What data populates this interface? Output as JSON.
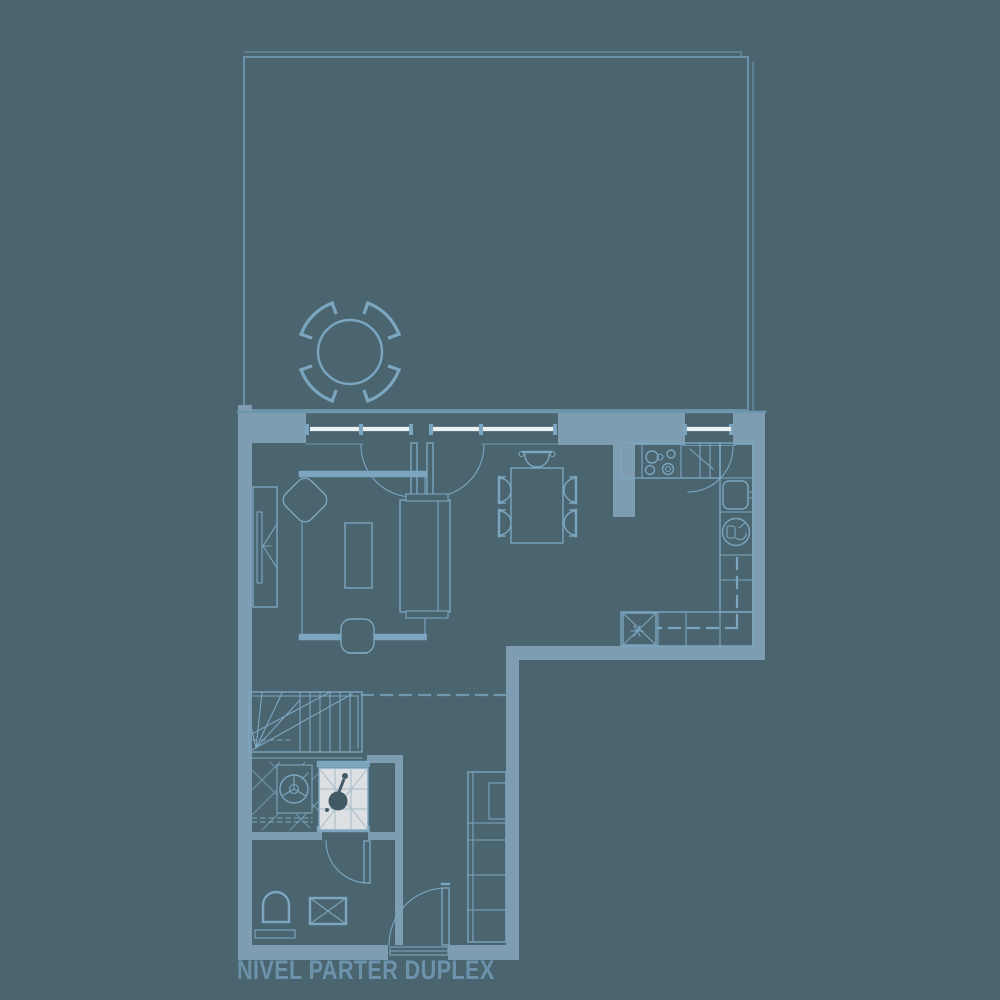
{
  "title": "NIVEL PARTER DUPLEX",
  "colors": {
    "background": "#4a6570",
    "wall": "#7e9db2",
    "line": "#7ca6c0",
    "line_soft": "#6e96ac",
    "glass": "#ecf1f3",
    "shower_fill": "#dce0e2",
    "shower_grid": "#a6bac5",
    "shower_symbol": "#415a66",
    "text": "#6c93ab"
  }
}
